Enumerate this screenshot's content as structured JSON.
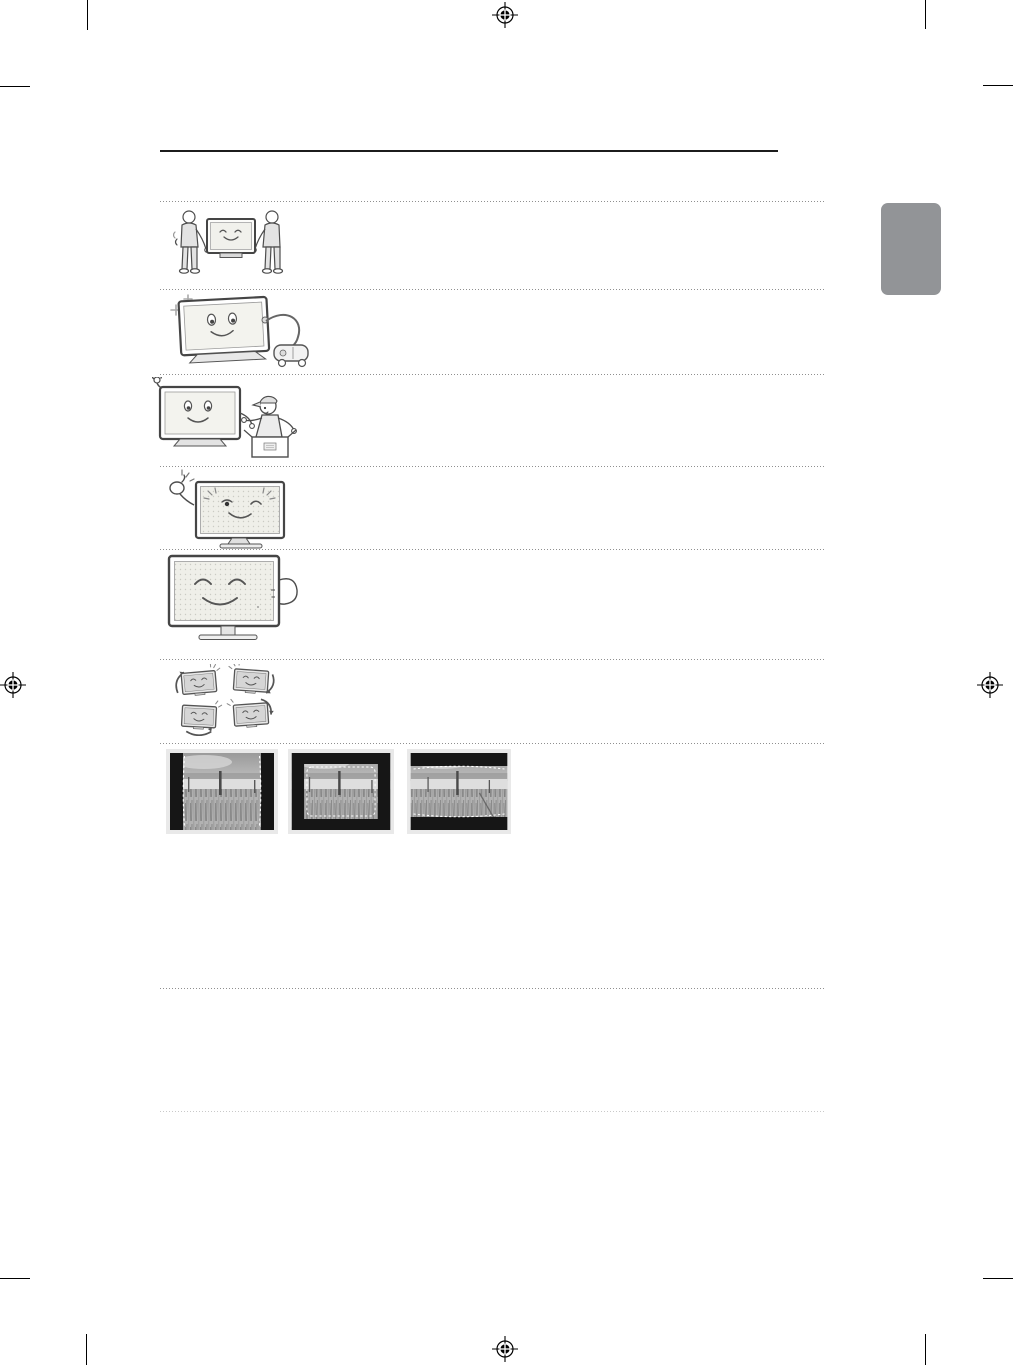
{
  "page": {
    "kind": "tv-user-manual-safety-page",
    "background": "#ffffff",
    "visible_text": ""
  },
  "print_layout": {
    "crop_mark_color": "#000000",
    "registration_mark_color": "#000000",
    "registration_marks": [
      "top-center",
      "left-middle",
      "right-middle",
      "bottom-center"
    ]
  },
  "header": {
    "rule_color": "#1c1c1c"
  },
  "side_tab": {
    "color": "#929497"
  },
  "separators": {
    "dot_color": "#8f8f8f",
    "light_dot_color": "#c9c9c9"
  },
  "safety_illustrations": [
    {
      "name": "two-people-carrying-tv"
    },
    {
      "name": "tv-cleaned-with-vacuum"
    },
    {
      "name": "tv-waving-and-service-technician-with-box"
    },
    {
      "name": "winking-tv-with-snapping-hand"
    },
    {
      "name": "hand-touching-tv-side"
    },
    {
      "name": "four-tvs-with-rotation-arrows"
    }
  ],
  "screen_image_examples": [
    {
      "name": "pillarbox-4-3-picture"
    },
    {
      "name": "windowbox-picture"
    },
    {
      "name": "letterbox-16-9-picture"
    }
  ],
  "photo_palette": {
    "sky_top": "#9a9a9a",
    "sky_bottom": "#cacaca",
    "fog": "#dedede",
    "grass": "#b2b2b2",
    "black_bars": "#161616",
    "dashed_guides": "#ffffff",
    "frame": "#e9e9e9"
  }
}
